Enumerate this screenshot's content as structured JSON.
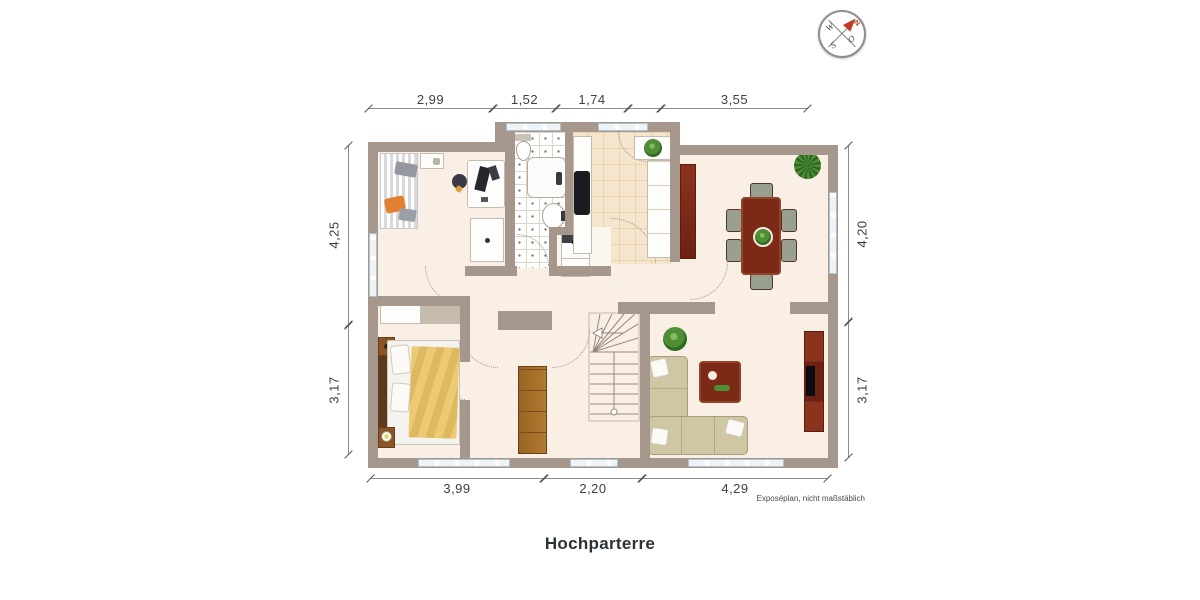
{
  "title": "Hochparterre",
  "footnote": "Exposéplan, nicht maßstäblich",
  "compass": {
    "n": "N",
    "e": "O",
    "s": "S",
    "w": "W"
  },
  "dimensions": {
    "top": [
      "2,99",
      "1,52",
      "1,74",
      "3,55"
    ],
    "bottom": [
      "3,99",
      "2,20",
      "4,29"
    ],
    "left": [
      "4,25",
      "3,17"
    ],
    "right": [
      "4,20",
      "3,17"
    ]
  },
  "colors": {
    "wall": "#a5978c",
    "floor": "#f9efe4",
    "kitchen_floor": "#f5e5cd",
    "bath_floor": "#ffffff",
    "wood_dark": "#7c2a17",
    "wood_light": "#9a6426",
    "sofa": "#cfc6a3",
    "accent_orange": "#e2802f",
    "plant_green": "#4e8f35",
    "window_glass": "#edf4f7",
    "compass_north": "#c13a24"
  }
}
